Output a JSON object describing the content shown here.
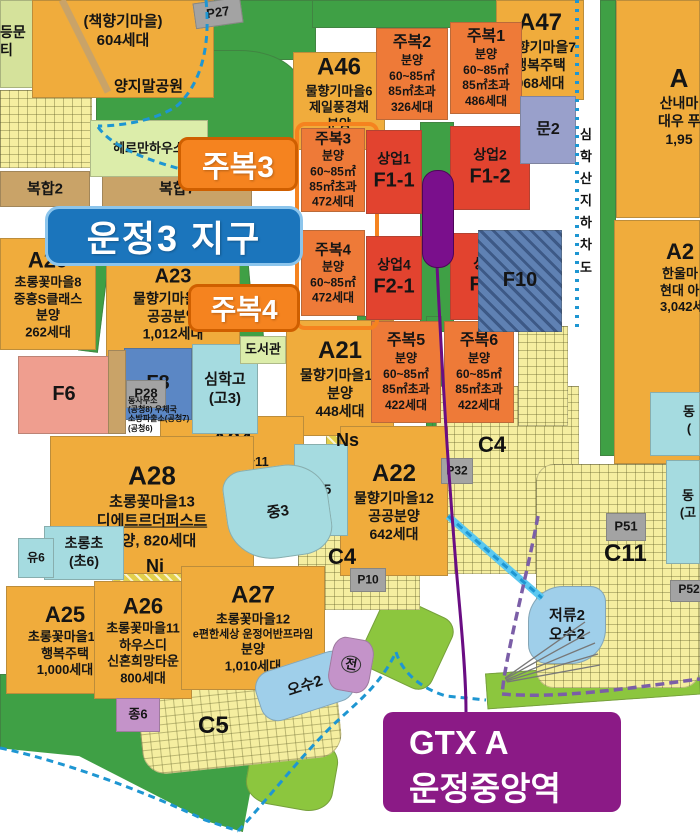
{
  "callouts": {
    "district": {
      "text": "운정3 지구"
    },
    "jubok3": {
      "text": "주복3"
    },
    "jubok4": {
      "text": "주복4"
    },
    "gtx": {
      "line1": "GTX A",
      "line2": "운정중앙역"
    }
  },
  "colors": {
    "residential_orange": "#F0AC3C",
    "mixed_use_orange": "#EE7A38",
    "commercial_red": "#E2432F",
    "park_green": "#3FA045",
    "buffer_green": "#8CC63E",
    "school_cyan": "#A5DBE0",
    "water_blue": "#9FCFEA",
    "facility_tan": "#C9A368",
    "parking_gray": "#A3A3A3",
    "station_purple": "#7A0F8C",
    "gtx_box_purple": "#8B1A86",
    "district_badge_blue": "#1B75BC",
    "jubok_badge_orange": "#F5831F",
    "boundary_dash_blue": "#1E96D2",
    "boundary_dash_purple": "#7B5EA7"
  },
  "parcels": [
    {
      "name": "park-topleft-pale",
      "x": 0,
      "y": 0,
      "w": 42,
      "h": 88,
      "bg": "#D5E29B"
    },
    {
      "name": "green-top-a",
      "x": 208,
      "y": 0,
      "w": 108,
      "h": 60,
      "bg": "#3FA045"
    },
    {
      "name": "green-top-b",
      "x": 312,
      "y": 0,
      "w": 192,
      "h": 28,
      "bg": "#3FA045"
    },
    {
      "name": "park-yangjimal",
      "x": 96,
      "y": 50,
      "w": 205,
      "h": 124,
      "bg": "#3FA045",
      "radius": "40% 30% 45% 35%"
    },
    {
      "name": "green-road-east",
      "x": 600,
      "y": 0,
      "w": 16,
      "h": 456,
      "bg": "#3FA045"
    },
    {
      "name": "green-strip-east-south",
      "x": 614,
      "y": 442,
      "w": 86,
      "h": 15,
      "bg": "#3FA045"
    },
    {
      "name": "green-station-strip",
      "x": 420,
      "y": 122,
      "w": 34,
      "h": 210,
      "bg": "#3FA045"
    },
    {
      "name": "green-col-1",
      "x": 357,
      "y": 316,
      "w": 16,
      "h": 114,
      "bg": "#3FA045"
    },
    {
      "name": "green-col-2",
      "x": 426,
      "y": 316,
      "w": 16,
      "h": 114,
      "bg": "#3FA045"
    },
    {
      "name": "green-col-3",
      "x": 432,
      "y": 392,
      "w": 9,
      "h": 180,
      "bg": "#3FA045"
    },
    {
      "name": "green-diag-1",
      "x": 84,
      "y": 252,
      "w": 20,
      "h": 100,
      "bg": "#3FA045",
      "rotate": 7
    },
    {
      "name": "green-diag-2",
      "x": 234,
      "y": 252,
      "w": 18,
      "h": 100,
      "bg": "#3FA045",
      "rotate": -5
    },
    {
      "name": "green-band-mid",
      "x": 112,
      "y": 324,
      "w": 152,
      "h": 34,
      "bg": "#3FA045",
      "rotate": -4
    },
    {
      "name": "park-south",
      "x": 0,
      "y": 674,
      "w": 264,
      "h": 158,
      "bg": "#3FA045",
      "clip": "polygon(0 0,100% 0,100% 28%,92% 100%,78% 93%,30% 52%,0 47%)"
    },
    {
      "name": "green-c5-south",
      "x": 248,
      "y": 736,
      "w": 88,
      "h": 72,
      "bg": "#8CC63E",
      "radius": "30%",
      "rotate": 10
    },
    {
      "name": "green-mid-south",
      "x": 368,
      "y": 604,
      "w": 78,
      "h": 78,
      "bg": "#8CC63E",
      "rotate": 25,
      "radius": "20%"
    },
    {
      "name": "green-bottom-right",
      "x": 486,
      "y": 666,
      "w": 214,
      "h": 36,
      "bg": "#8CC63E",
      "rotate": -4
    },
    {
      "name": "green-osu-west",
      "x": 250,
      "y": 646,
      "w": 18,
      "h": 56,
      "bg": "#8CC63E",
      "rotate": -12
    },
    {
      "name": "green-c11-a",
      "x": 636,
      "y": 596,
      "w": 24,
      "h": 18,
      "bg": "#3FA045"
    },
    {
      "name": "green-c11-b",
      "x": 548,
      "y": 626,
      "w": 20,
      "h": 36,
      "bg": "#3FA045"
    },
    {
      "name": "green-lot-a",
      "x": 28,
      "y": 96,
      "w": 18,
      "h": 14,
      "bg": "#3FA045"
    },
    {
      "name": "green-lot-b",
      "x": 8,
      "y": 128,
      "w": 16,
      "h": 12,
      "bg": "#3FA045"
    },
    {
      "name": "lots-topleft",
      "x": 0,
      "y": 90,
      "w": 92,
      "h": 78,
      "pattern": "lots"
    },
    {
      "name": "lots-c4-upper",
      "x": 436,
      "y": 386,
      "w": 143,
      "h": 188,
      "pattern": "lots"
    },
    {
      "name": "lots-east-jubok6",
      "x": 518,
      "y": 326,
      "w": 50,
      "h": 100,
      "pattern": "lots"
    },
    {
      "name": "lots-c4-lower",
      "x": 298,
      "y": 532,
      "w": 122,
      "h": 78,
      "pattern": "lots"
    },
    {
      "name": "lots-c5",
      "x": 140,
      "y": 684,
      "w": 200,
      "h": 82,
      "pattern": "lots",
      "radius": "24px",
      "rotate": -6
    },
    {
      "name": "lots-c11",
      "x": 536,
      "y": 464,
      "w": 164,
      "h": 224,
      "pattern": "lots",
      "radius": "18px"
    },
    {
      "name": "hatch-ni",
      "x": 112,
      "y": 556,
      "w": 126,
      "h": 26,
      "pattern": "hatchy"
    },
    {
      "name": "hatch-ns",
      "x": 326,
      "y": 426,
      "w": 50,
      "h": 40,
      "pattern": "hatchy"
    },
    {
      "name": "parcel-chaekhyanggi",
      "x": 32,
      "y": 0,
      "w": 182,
      "h": 98,
      "bg": "#F0AC3C",
      "lines": [
        "(책향기마을)",
        "604세대"
      ],
      "fs": 15,
      "ly": 12
    },
    {
      "name": "parcel-a46",
      "x": 293,
      "y": 52,
      "w": 92,
      "h": 98,
      "bg": "#F0AC3C",
      "lines": [
        "A46",
        "물향기마을6",
        "제일풍경채",
        "분양",
        "400세대"
      ],
      "fs": 13,
      "big": 24
    },
    {
      "name": "parcel-a47",
      "x": 496,
      "y": 0,
      "w": 88,
      "h": 100,
      "bg": "#F0AC3C",
      "lines": [
        "A47",
        "물향기마을7",
        "행복주택",
        "968세대"
      ],
      "fs": 14,
      "big": 24
    },
    {
      "name": "parcel-sannae",
      "x": 616,
      "y": 0,
      "w": 84,
      "h": 218,
      "bg": "#F0AC3C",
      "lines": [
        "A",
        "산내마",
        "대우 푸",
        "1,95"
      ],
      "fs": 14,
      "big": 26,
      "lx": 42,
      "ly": 62
    },
    {
      "name": "parcel-hanul",
      "x": 614,
      "y": 220,
      "w": 86,
      "h": 244,
      "bg": "#F0AC3C",
      "lines": [
        "A2",
        "한울마",
        "현대 아이",
        "3,042세"
      ],
      "fs": 13,
      "big": 22,
      "lx": 46,
      "ly": 18
    },
    {
      "name": "parcel-a29",
      "x": 0,
      "y": 238,
      "w": 96,
      "h": 112,
      "bg": "#F0AC3C",
      "lines": [
        "A29",
        "초롱꽃마을8",
        "중흥S클래스",
        "분양",
        "262세대"
      ],
      "fs": 13,
      "big": 22
    },
    {
      "name": "parcel-a23",
      "x": 106,
      "y": 250,
      "w": 134,
      "h": 108,
      "bg": "#F0AC3C",
      "lines": [
        "A23",
        "물향기마을10",
        "공공분양",
        "1,012세대"
      ],
      "fs": 14,
      "big": 20
    },
    {
      "name": "parcel-a21",
      "x": 286,
      "y": 320,
      "w": 108,
      "h": 116,
      "bg": "#F0AC3C",
      "lines": [
        "A21",
        "물향기마을13",
        "분양",
        "448세대"
      ],
      "fs": 14,
      "big": 24
    },
    {
      "name": "parcel-a24",
      "x": 160,
      "y": 416,
      "w": 144,
      "h": 98,
      "bg": "#F0AC3C",
      "lines": [
        "A24",
        "물향기마을11",
        "국민임대,영구임대",
        "1,078세대"
      ],
      "fs": 13,
      "big": 22
    },
    {
      "name": "parcel-a28",
      "x": 50,
      "y": 436,
      "w": 204,
      "h": 138,
      "bg": "#F0AC3C",
      "lines": [
        "A28",
        "초롱꽃마을13",
        "디에트르더퍼스트",
        "분양, 820세대"
      ],
      "fs": 15,
      "big": 26,
      "u": 2
    },
    {
      "name": "parcel-a22",
      "x": 340,
      "y": 426,
      "w": 108,
      "h": 150,
      "bg": "#F0AC3C",
      "lines": [
        "A22",
        "물향기마을12",
        "공공분양",
        "642세대"
      ],
      "fs": 14,
      "big": 24
    },
    {
      "name": "parcel-a25",
      "x": 6,
      "y": 586,
      "w": 118,
      "h": 108,
      "bg": "#F0AC3C",
      "lines": [
        "A25",
        "초롱꽃마을10",
        "행복주택",
        "1,000세대"
      ],
      "fs": 13,
      "big": 22
    },
    {
      "name": "parcel-a26",
      "x": 94,
      "y": 581,
      "w": 98,
      "h": 118,
      "bg": "#F0AC3C",
      "lines": [
        "A26",
        "초롱꽃마을11",
        "하우스디",
        "신혼희망타운",
        "800세대"
      ],
      "fs": 13,
      "big": 22
    },
    {
      "name": "parcel-a27",
      "x": 181,
      "y": 566,
      "w": 144,
      "h": 124,
      "bg": "#F0AC3C",
      "lines": [
        "A27",
        "초롱꽃마을12",
        "e편한세상 운정어반프라임",
        "분양",
        "1,010세대"
      ],
      "fs": 13,
      "big": 24,
      "small": [
        2
      ]
    },
    {
      "name": "parcel-jubok2",
      "x": 376,
      "y": 28,
      "w": 72,
      "h": 92,
      "bg": "#EE7A38",
      "lines": [
        "주복2",
        "분양",
        "60~85㎡",
        "85㎡초과",
        "326세대"
      ],
      "fs": 12,
      "big": 16
    },
    {
      "name": "parcel-jubok1",
      "x": 450,
      "y": 22,
      "w": 72,
      "h": 92,
      "bg": "#EE7A38",
      "lines": [
        "주복1",
        "분양",
        "60~85㎡",
        "85㎡초과",
        "486세대"
      ],
      "fs": 12,
      "big": 16
    },
    {
      "name": "parcel-jubok3",
      "x": 301,
      "y": 128,
      "w": 64,
      "h": 84,
      "bg": "#EE7A38",
      "lines": [
        "주복3",
        "분양",
        "60~85㎡",
        "85㎡초과",
        "472세대"
      ],
      "fs": 12,
      "big": 15
    },
    {
      "name": "parcel-jubok4",
      "x": 301,
      "y": 230,
      "w": 64,
      "h": 86,
      "bg": "#EE7A38",
      "lines": [
        "주복4",
        "분양",
        "60~85㎡",
        "472세대"
      ],
      "fs": 12,
      "big": 15
    },
    {
      "name": "parcel-jubok5",
      "x": 371,
      "y": 321,
      "w": 70,
      "h": 102,
      "bg": "#EE7A38",
      "lines": [
        "주복5",
        "분양",
        "60~85㎡",
        "85㎡초과",
        "422세대"
      ],
      "fs": 12,
      "big": 16
    },
    {
      "name": "parcel-jubok6",
      "x": 444,
      "y": 321,
      "w": 70,
      "h": 102,
      "bg": "#EE7A38",
      "lines": [
        "주복6",
        "분양",
        "60~85㎡",
        "85㎡초과",
        "422세대"
      ],
      "fs": 12,
      "big": 16
    },
    {
      "name": "jubok34-outline",
      "x": 295,
      "y": 122,
      "w": 76,
      "h": 200,
      "border": "4px solid #F5831F",
      "radius": "10px"
    },
    {
      "name": "parcel-sangup1",
      "x": 366,
      "y": 130,
      "w": 56,
      "h": 84,
      "bg": "#E2432F",
      "lines": [
        "상업1",
        "F1-1"
      ],
      "fs": 14,
      "bigLast": 20
    },
    {
      "name": "parcel-sangup2",
      "x": 450,
      "y": 126,
      "w": 80,
      "h": 84,
      "bg": "#E2432F",
      "lines": [
        "상업2",
        "F1-2"
      ],
      "fs": 14,
      "bigLast": 20
    },
    {
      "name": "parcel-sangup4",
      "x": 366,
      "y": 236,
      "w": 56,
      "h": 84,
      "bg": "#E2432F",
      "lines": [
        "상업4",
        "F2-1"
      ],
      "fs": 14,
      "bigLast": 20
    },
    {
      "name": "parcel-sangup5",
      "x": 450,
      "y": 233,
      "w": 80,
      "h": 87,
      "bg": "#E2432F",
      "lines": [
        "상업5",
        "F2-2"
      ],
      "fs": 14,
      "bigLast": 20
    },
    {
      "name": "parcel-mun2",
      "x": 520,
      "y": 96,
      "w": 56,
      "h": 68,
      "bg": "#99A0CB",
      "lines": [
        "문2"
      ],
      "fs": 16
    },
    {
      "name": "parcel-p27",
      "x": 194,
      "y": 0,
      "w": 48,
      "h": 26,
      "bg": "#A3A3A3",
      "lines": [
        "P27"
      ],
      "fs": 13,
      "rotate": -8
    },
    {
      "name": "parcel-f10",
      "x": 478,
      "y": 230,
      "w": 84,
      "h": 102,
      "pattern": "hatchb",
      "lines": [
        "F10"
      ],
      "fs": 20
    },
    {
      "name": "parcel-f8",
      "x": 124,
      "y": 348,
      "w": 68,
      "h": 72,
      "bg": "#5B87C5",
      "lines": [
        "F8"
      ],
      "fs": 20
    },
    {
      "name": "parcel-p28",
      "x": 126,
      "y": 380,
      "w": 40,
      "h": 28,
      "bg": "#A3A3A3",
      "lines": [
        "P28"
      ],
      "fs": 13
    },
    {
      "name": "parcel-simhak-highschool",
      "x": 192,
      "y": 344,
      "w": 66,
      "h": 90,
      "bg": "#A5DBE0",
      "lines": [
        "심학고",
        "(고3)"
      ],
      "fs": 15
    },
    {
      "name": "parcel-library",
      "x": 240,
      "y": 336,
      "w": 46,
      "h": 28,
      "bg": "#DCEDAA",
      "lines": [
        "도서관"
      ],
      "fs": 13
    },
    {
      "name": "parcel-f6",
      "x": 18,
      "y": 356,
      "w": 92,
      "h": 78,
      "bg": "#EF9E8F",
      "pattern": "rooms",
      "lines": [
        "F6"
      ],
      "fs": 20
    },
    {
      "name": "parcel-tan-column",
      "x": 108,
      "y": 350,
      "w": 18,
      "h": 84,
      "bg": "#C9A368"
    },
    {
      "name": "parcel-bokhap2",
      "x": 0,
      "y": 171,
      "w": 90,
      "h": 36,
      "bg": "#C9A368",
      "lines": [
        "복합2"
      ],
      "fs": 15
    },
    {
      "name": "parcel-bokhap7",
      "x": 102,
      "y": 171,
      "w": 150,
      "h": 36,
      "bg": "#C9A368",
      "lines": [
        "복합7"
      ],
      "fs": 15
    },
    {
      "name": "parcel-herrmann",
      "x": 90,
      "y": 120,
      "w": 118,
      "h": 57,
      "bg": "#DCEDAA",
      "lines": [
        "헤르만하우스"
      ],
      "fs": 13
    },
    {
      "name": "parcel-chorong-elementary",
      "x": 44,
      "y": 526,
      "w": 80,
      "h": 54,
      "bg": "#A5DBE0",
      "lines": [
        "초롱초",
        "(초6)"
      ],
      "fs": 14
    },
    {
      "name": "parcel-yu6",
      "x": 18,
      "y": 538,
      "w": 36,
      "h": 40,
      "bg": "#A5DBE0",
      "lines": [
        "유6"
      ],
      "fs": 12
    },
    {
      "name": "parcel-cho5",
      "x": 294,
      "y": 444,
      "w": 54,
      "h": 92,
      "bg": "#A5DBE0",
      "lines": [
        "초5"
      ],
      "fs": 14
    },
    {
      "name": "parcel-jung3",
      "x": 226,
      "y": 466,
      "w": 104,
      "h": 92,
      "bg": "#A5DBE0",
      "lines": [
        "중3"
      ],
      "fs": 15,
      "radius": "20% 40% 30% 45%",
      "rotate": -8
    },
    {
      "name": "parcel-dongpae-1",
      "x": 650,
      "y": 392,
      "w": 50,
      "h": 64,
      "bg": "#A5DBE0",
      "lines": [
        "동",
        "("
      ],
      "fs": 13,
      "lx": 28,
      "ly": 12
    },
    {
      "name": "parcel-dongpae-2",
      "x": 666,
      "y": 460,
      "w": 34,
      "h": 104,
      "bg": "#A5DBE0",
      "lines": [
        "동",
        "(고"
      ],
      "fs": 13,
      "lx": 10,
      "ly": 28
    },
    {
      "name": "parcel-jeoryu2",
      "x": 528,
      "y": 586,
      "w": 78,
      "h": 78,
      "bg": "#9FCFEA",
      "lines": [
        "저류2",
        "오수2"
      ],
      "fs": 15,
      "radius": "45% 20% 45% 25%"
    },
    {
      "name": "parcel-osu2-west",
      "x": 256,
      "y": 660,
      "w": 98,
      "h": 52,
      "bg": "#9FCFEA",
      "lines": [
        "오수2"
      ],
      "fs": 15,
      "rotate": -18,
      "radius": "18px"
    },
    {
      "name": "parcel-jeon",
      "x": 330,
      "y": 638,
      "w": 42,
      "h": 54,
      "bg": "#C493C9",
      "lines": [
        "전"
      ],
      "fs": 13,
      "rotate": 10,
      "radius": "30%",
      "circle": true
    },
    {
      "name": "parcel-jong6",
      "x": 116,
      "y": 698,
      "w": 44,
      "h": 34,
      "bg": "#C493C9",
      "lines": [
        "종6"
      ],
      "fs": 13
    },
    {
      "name": "parcel-p32",
      "x": 441,
      "y": 458,
      "w": 32,
      "h": 26,
      "bg": "#A3A3A3",
      "lines": [
        "P32"
      ],
      "fs": 12
    },
    {
      "name": "parcel-p10",
      "x": 350,
      "y": 568,
      "w": 36,
      "h": 24,
      "bg": "#A3A3A3",
      "lines": [
        "P10"
      ],
      "fs": 12
    },
    {
      "name": "parcel-p51",
      "x": 606,
      "y": 513,
      "w": 40,
      "h": 28,
      "bg": "#A3A3A3",
      "lines": [
        "P51"
      ],
      "fs": 13
    },
    {
      "name": "parcel-p52",
      "x": 670,
      "y": 580,
      "w": 34,
      "h": 22,
      "bg": "#A3A3A3",
      "lines": [
        "P52"
      ],
      "fs": 12,
      "lx": 4,
      "ly": 2
    }
  ],
  "labels": [
    {
      "name": "frag-deungmun",
      "text": "등문",
      "x": 0,
      "y": 24,
      "fs": 14
    },
    {
      "name": "frag-ti",
      "text": "티",
      "x": 0,
      "y": 42,
      "fs": 14
    },
    {
      "name": "label-yangjimal-park",
      "text": "양지말공원",
      "x": 114,
      "y": 78,
      "fs": 15
    },
    {
      "name": "label-ns",
      "text": "Ns",
      "x": 336,
      "y": 430,
      "fs": 18
    },
    {
      "name": "label-ni",
      "text": "Ni",
      "x": 146,
      "y": 556,
      "fs": 18
    },
    {
      "name": "label-c4-upper",
      "text": "C4",
      "x": 478,
      "y": 432,
      "fs": 22
    },
    {
      "name": "label-c4-lower",
      "text": "C4",
      "x": 328,
      "y": 544,
      "fs": 22
    },
    {
      "name": "label-c5",
      "text": "C5",
      "x": 198,
      "y": 712,
      "fs": 24
    },
    {
      "name": "label-c11",
      "text": "C11",
      "x": 604,
      "y": 540,
      "fs": 24
    },
    {
      "name": "label-govt-offices",
      "lines": [
        "동사무소",
        "(공청8)   우체국",
        "소방파출소(공청7)",
        "(공청6)"
      ],
      "x": 128,
      "y": 396,
      "fs": 8
    },
    {
      "name": "road-simhaksan-underpass",
      "text": "심학산지하차도",
      "x": 580,
      "y": 124,
      "fs": 13,
      "vertical": true
    }
  ]
}
